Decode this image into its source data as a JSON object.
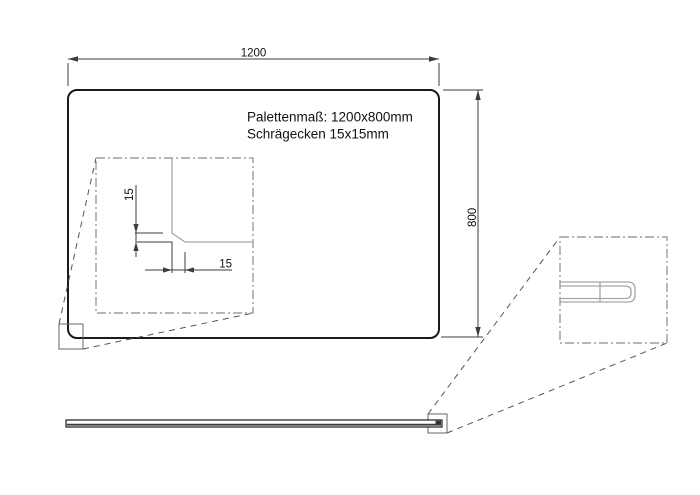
{
  "drawing": {
    "note": {
      "line1": "Palettenmaß: 1200x800mm",
      "line2": "Schrägecken 15x15mm"
    },
    "dimensions": {
      "width": {
        "value": "1200",
        "unit": "mm"
      },
      "height": {
        "value": "800",
        "unit": "mm"
      },
      "chamfer_vertical": {
        "value": "15",
        "unit": "mm"
      },
      "chamfer_horizontal": {
        "value": "15",
        "unit": "mm"
      }
    },
    "colors": {
      "background": "#ffffff",
      "outline": "#1a1a1a",
      "dimension": "#3c3c3c",
      "detail-line": "#a6a6a6",
      "detail-border": "#8c8c8c",
      "leader": "#555555",
      "marker": "#666666"
    }
  }
}
